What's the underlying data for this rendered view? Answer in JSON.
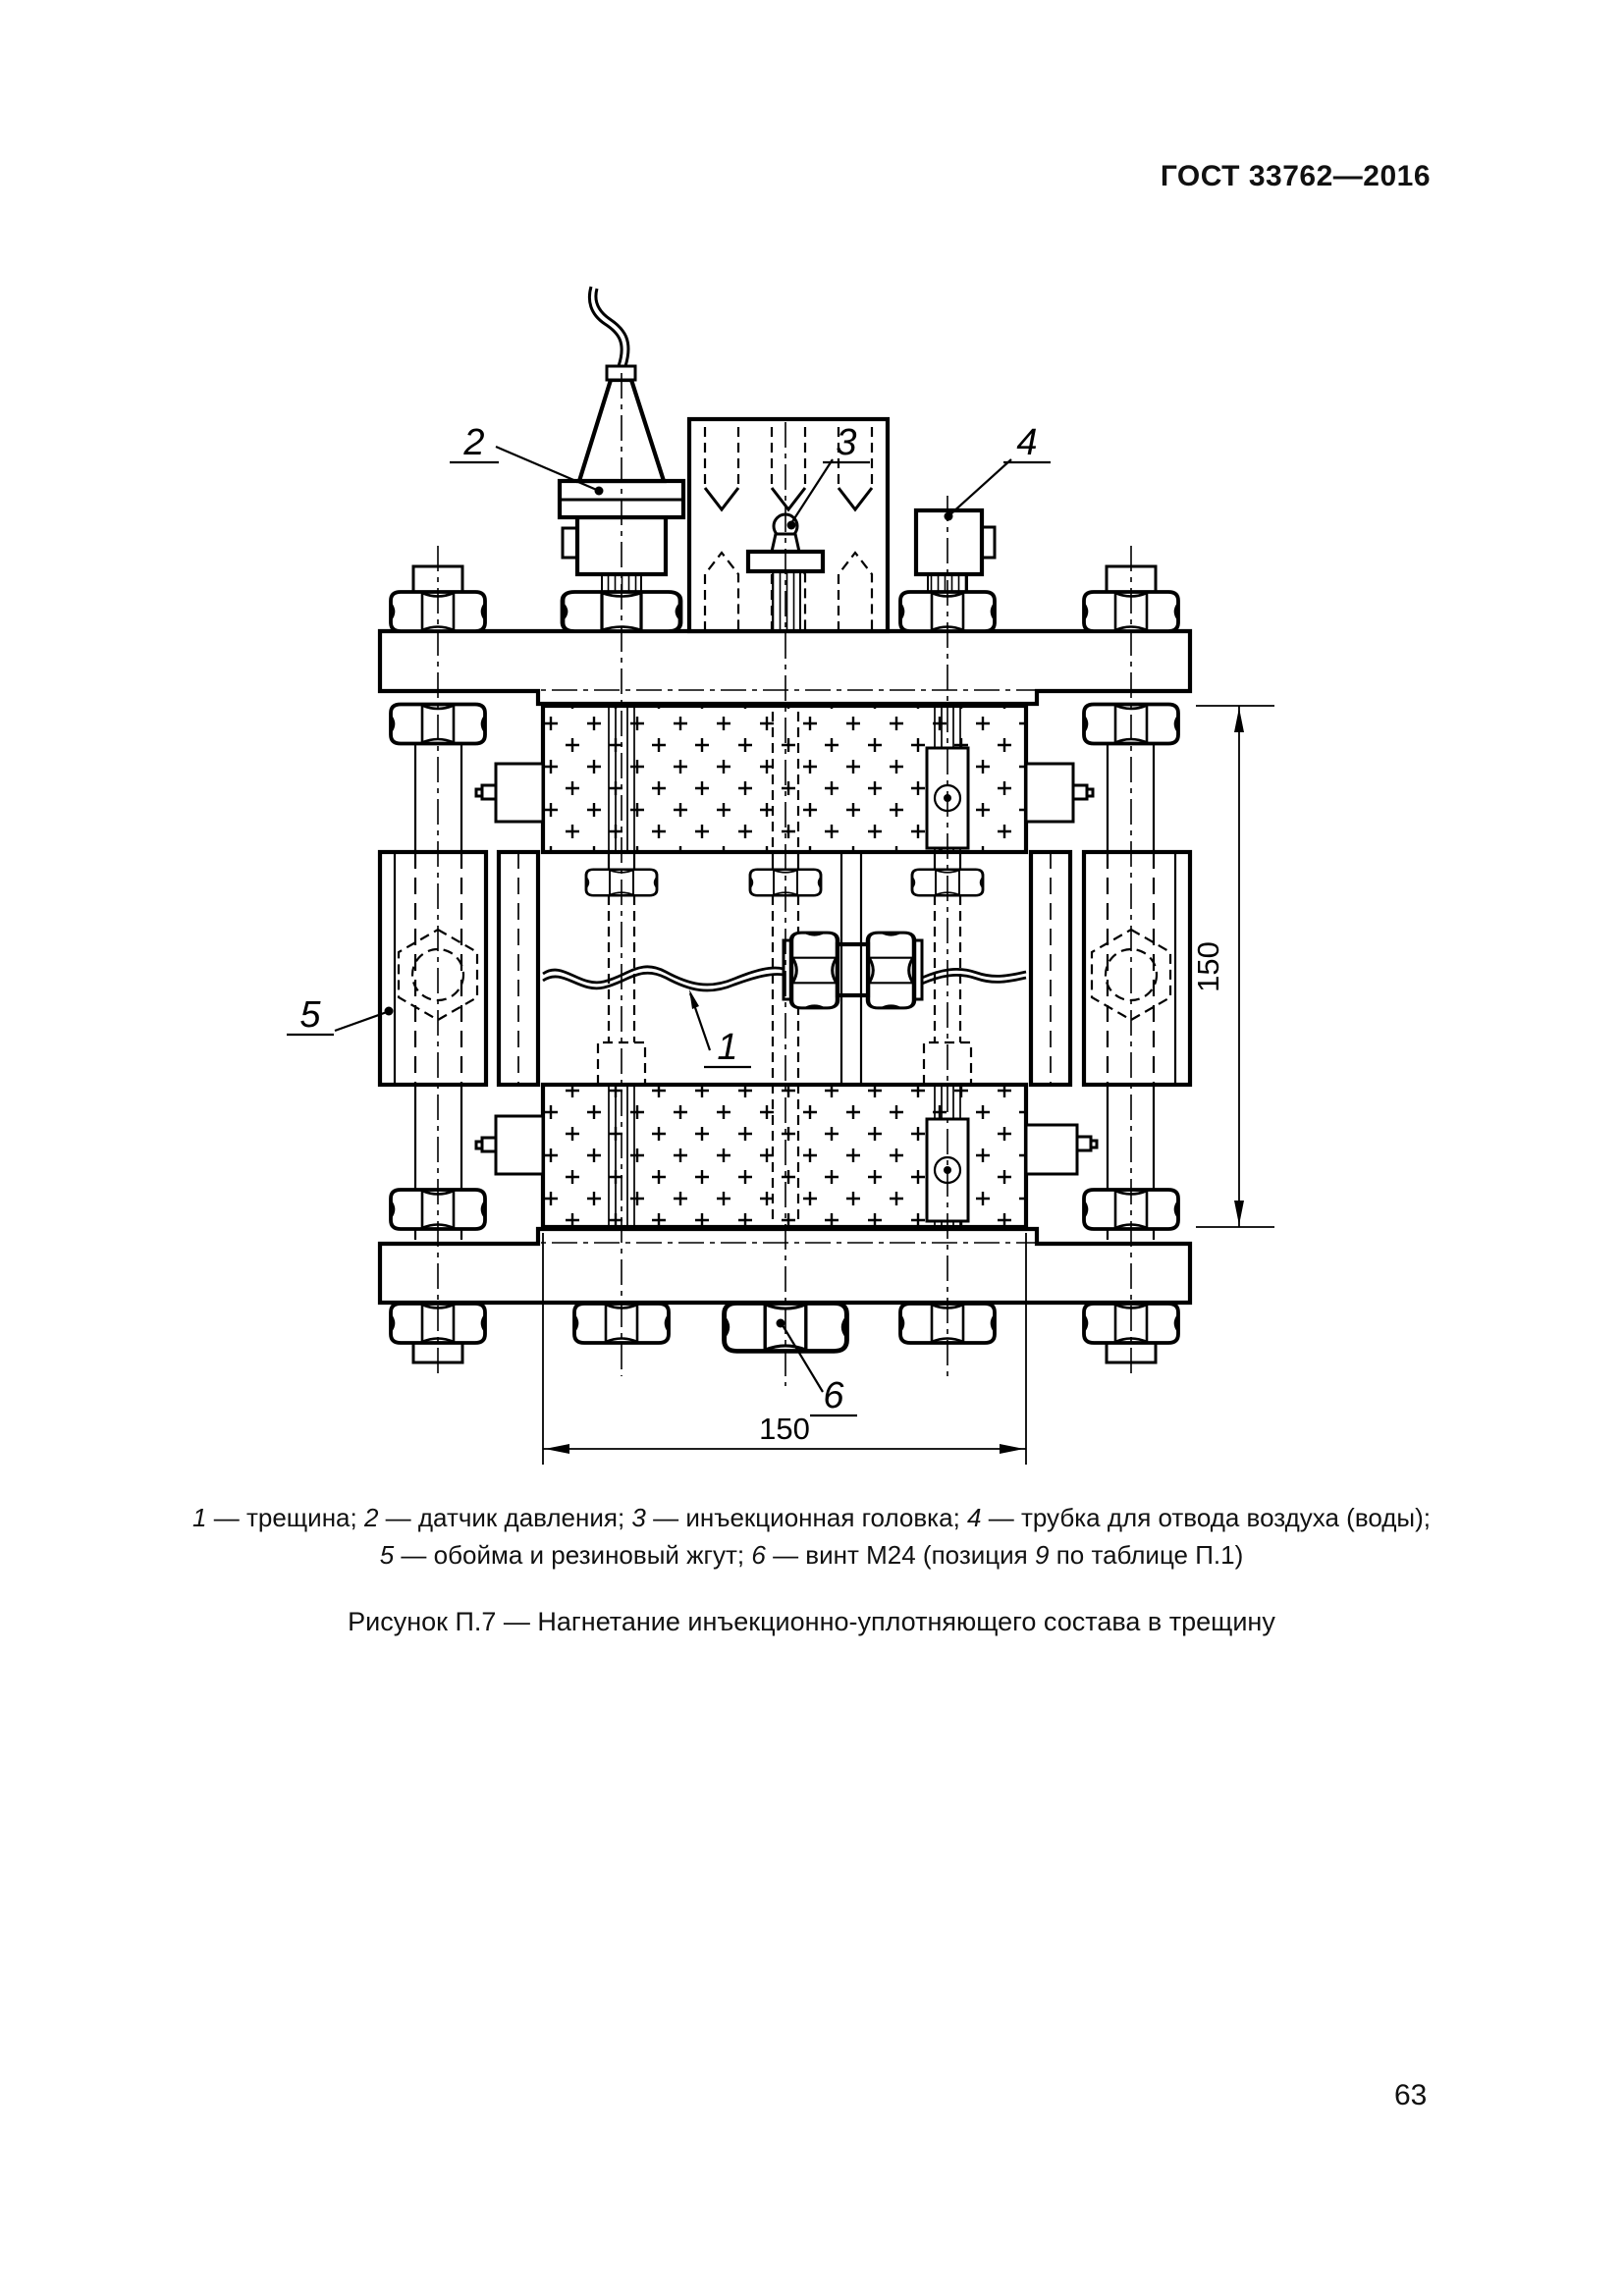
{
  "page": {
    "header": "ГОСТ 33762—2016",
    "page_number": "63"
  },
  "figure": {
    "title": "Рисунок П.7 — Нагнетание инъекционно-уплотняющего состава в трещину",
    "legend_line1": [
      {
        "i": "1"
      },
      {
        "t": " — трещина; "
      },
      {
        "i": "2"
      },
      {
        "t": " — датчик давления; "
      },
      {
        "i": "3"
      },
      {
        "t": " — инъекционная головка; "
      },
      {
        "i": "4"
      },
      {
        "t": " — трубка для отвода воздуха (воды);"
      }
    ],
    "legend_line2": [
      {
        "i": "5"
      },
      {
        "t": " — обойма и резиновый жгут; "
      },
      {
        "i": "6"
      },
      {
        "t": " — винт М24 (позиция "
      },
      {
        "i": "9"
      },
      {
        "t": " по таблице П.1)"
      }
    ],
    "callouts": {
      "c1": "1",
      "c2": "2",
      "c3": "3",
      "c4": "4",
      "c5": "5",
      "c6": "6"
    },
    "dimensions": {
      "vertical": "150",
      "horizontal": "150"
    }
  }
}
